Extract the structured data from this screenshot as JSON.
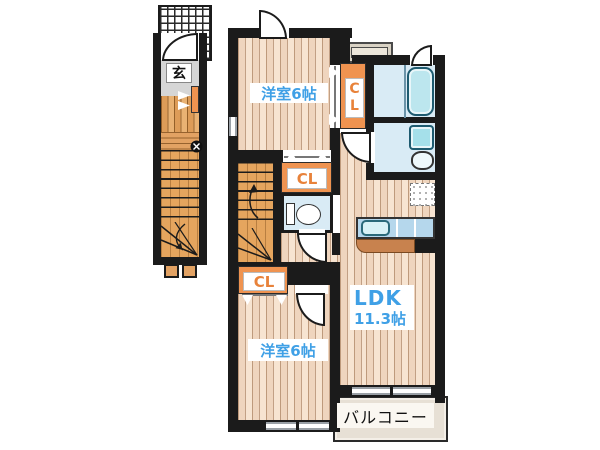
{
  "floor_plan": {
    "first_floor": {
      "entrance_label": "玄"
    },
    "second_floor": {
      "bedroom_top": {
        "label": "洋室6帖"
      },
      "bedroom_bottom": {
        "label": "洋室6帖"
      },
      "closets": [
        {
          "label": "CL"
        },
        {
          "label": "CL"
        },
        {
          "label": "CL"
        }
      ],
      "ldk": {
        "label": "LDK",
        "size": "11.3帖"
      },
      "balcony": {
        "label": "バルコニー"
      }
    },
    "colors": {
      "wall": "#1b1b1b",
      "room_label_text": "#3fa0e6",
      "closet_fill": "#ef9350",
      "closet_text": "#e8823a",
      "flooring_light": "#f3ddc8",
      "flooring_entrance": "#e2a263",
      "stairs": "#e5a55e",
      "water_area": "#d9ebf5",
      "fixture_outline": "#1e5b70",
      "kitchen_counter_top": "#b5d7ec",
      "kitchen_counter_base": "#c8824e",
      "balcony_fill": "#e7e0d5"
    }
  }
}
